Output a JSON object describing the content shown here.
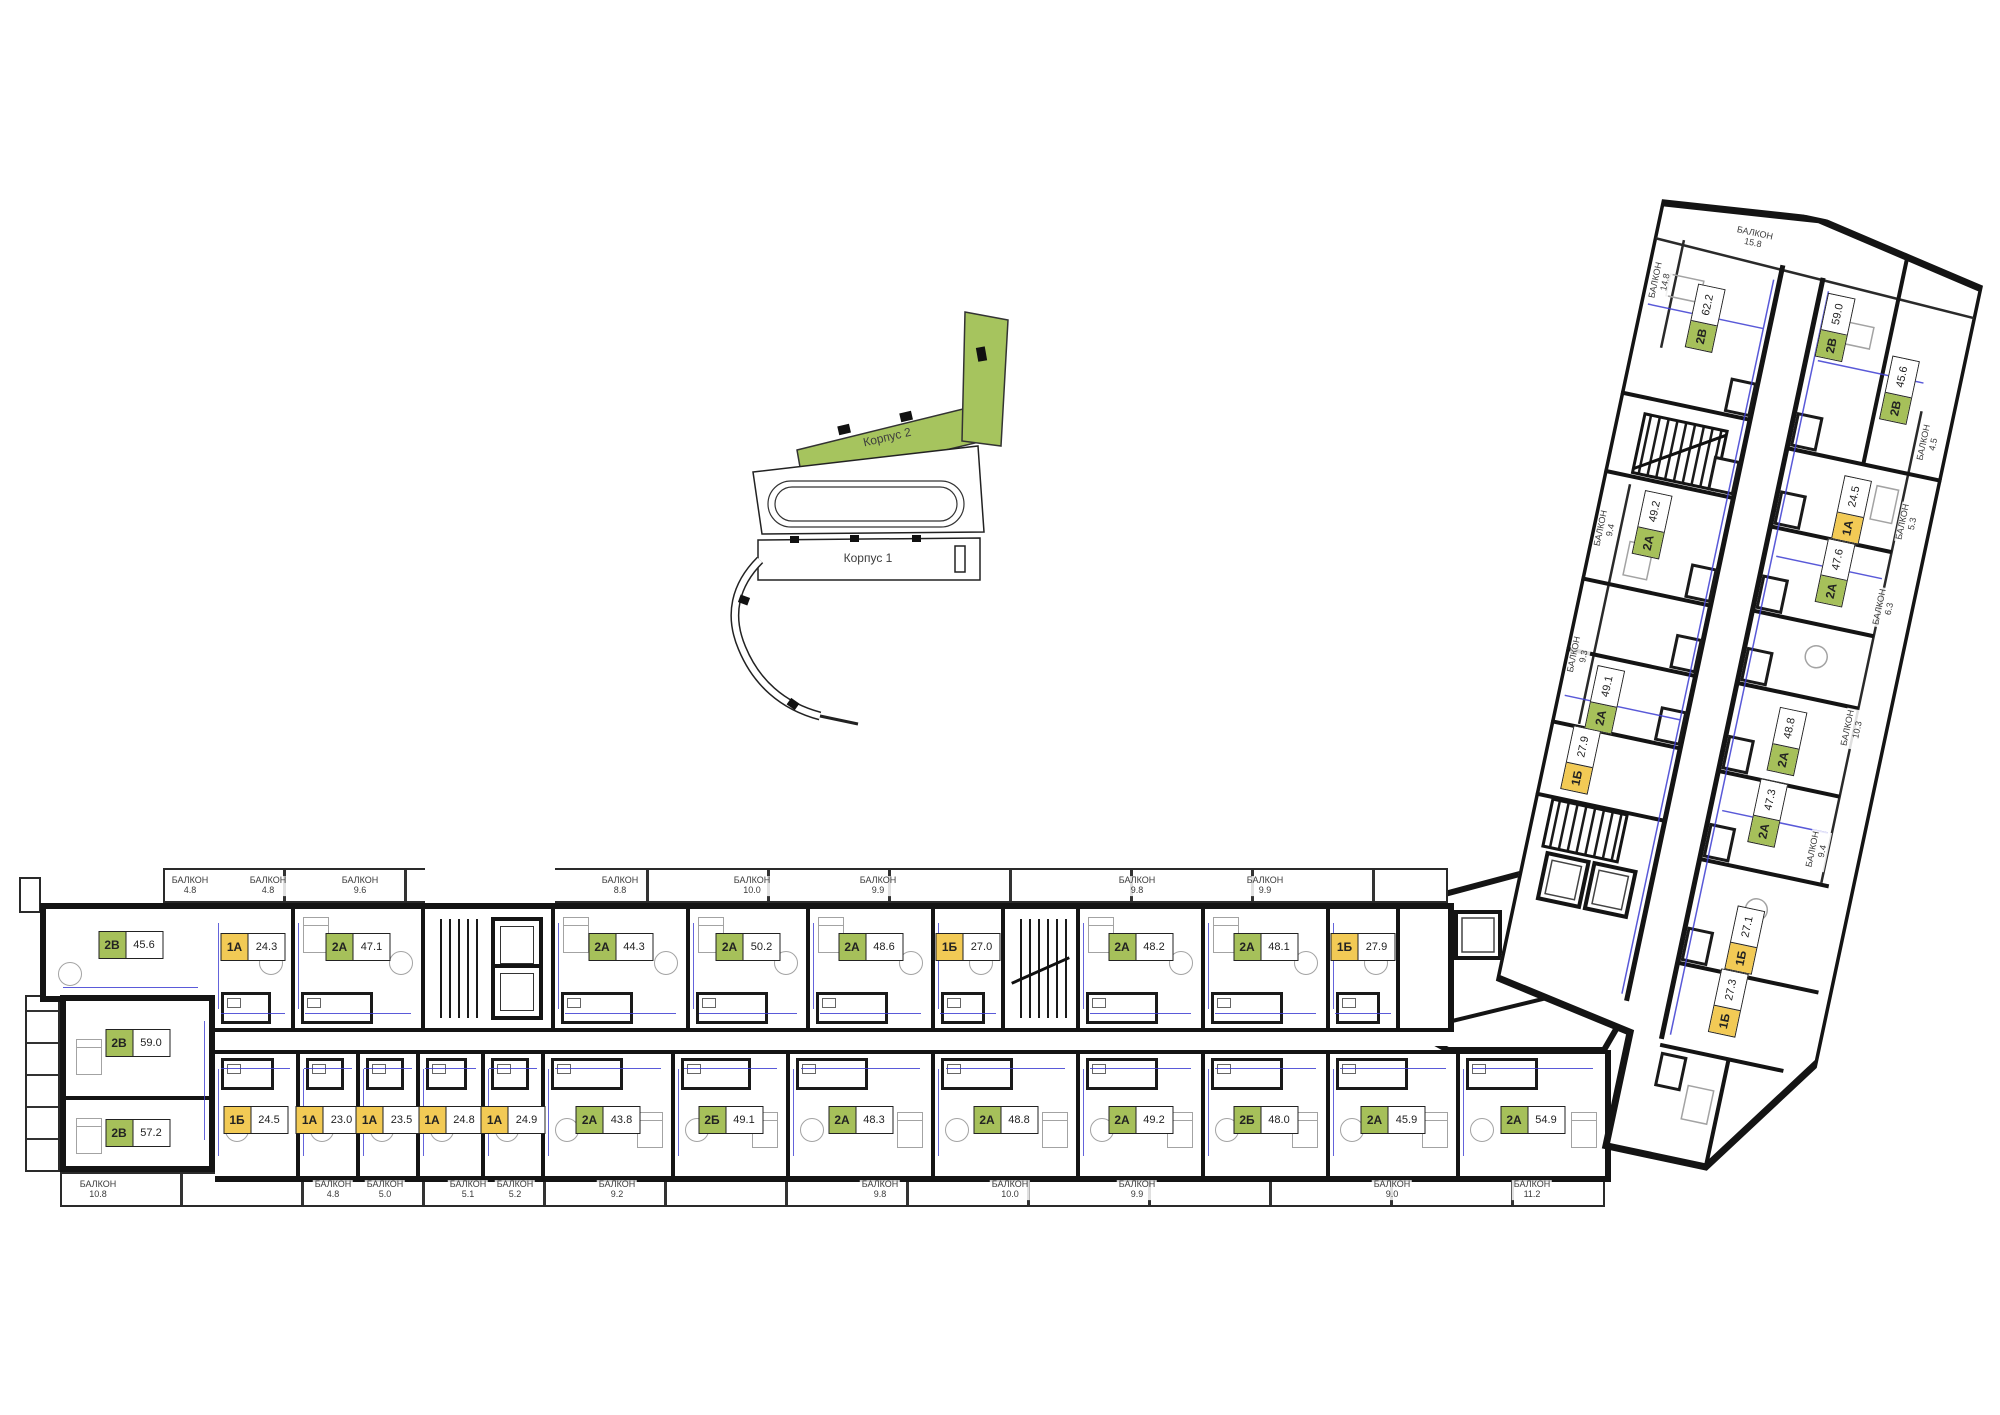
{
  "title_hidden": "",
  "colors": {
    "green": "#a6c05a",
    "yellow": "#f2ca55",
    "wall": "#141414",
    "dim_blue": "#3d3dd2",
    "furniture": "#a3a3a3",
    "balcony_text": "#3a3a3a",
    "locator_green": "#a6c45e"
  },
  "locator": {
    "building2": "Корпус 2",
    "building1": "Корпус 1"
  },
  "balcony_word": "БАЛКОН",
  "left_units": [
    {
      "t": "2В",
      "a": "45.6",
      "c": "g"
    },
    {
      "t": "2В",
      "a": "59.0",
      "c": "g"
    },
    {
      "t": "2В",
      "a": "57.2",
      "c": "g"
    }
  ],
  "h_top_units": [
    {
      "kind": "unit",
      "t": "1А",
      "a": "24.3",
      "c": "y",
      "w": 80
    },
    {
      "kind": "unit",
      "t": "2А",
      "a": "47.1",
      "c": "g",
      "w": 130
    },
    {
      "kind": "core",
      "w": 130
    },
    {
      "kind": "unit",
      "t": "2А",
      "a": "44.3",
      "c": "g",
      "w": 135
    },
    {
      "kind": "unit",
      "t": "2А",
      "a": "50.2",
      "c": "g",
      "w": 120
    },
    {
      "kind": "unit",
      "t": "2А",
      "a": "48.6",
      "c": "g",
      "w": 125
    },
    {
      "kind": "unit",
      "t": "1Б",
      "a": "27.0",
      "c": "y",
      "w": 70
    },
    {
      "kind": "stairs",
      "w": 75
    },
    {
      "kind": "unit",
      "t": "2А",
      "a": "48.2",
      "c": "g",
      "w": 125
    },
    {
      "kind": "unit",
      "t": "2А",
      "a": "48.1",
      "c": "g",
      "w": 125
    },
    {
      "kind": "unit",
      "t": "1Б",
      "a": "27.9",
      "c": "y",
      "w": 70
    },
    {
      "kind": "lobby",
      "w": 48
    }
  ],
  "h_bottom_units": [
    {
      "kind": "unit",
      "t": "1Б",
      "a": "24.5",
      "c": "y",
      "w": 85
    },
    {
      "kind": "unit",
      "t": "1А",
      "a": "23.0",
      "c": "y",
      "w": 60
    },
    {
      "kind": "unit",
      "t": "1А",
      "a": "23.5",
      "c": "y",
      "w": 60
    },
    {
      "kind": "unit",
      "t": "1А",
      "a": "24.8",
      "c": "y",
      "w": 65
    },
    {
      "kind": "unit",
      "t": "1А",
      "a": "24.9",
      "c": "y",
      "w": 60
    },
    {
      "kind": "unit",
      "t": "2А",
      "a": "43.8",
      "c": "g",
      "w": 130
    },
    {
      "kind": "unit",
      "t": "2Б",
      "a": "49.1",
      "c": "g",
      "w": 115
    },
    {
      "kind": "unit",
      "t": "2А",
      "a": "48.3",
      "c": "g",
      "w": 145
    },
    {
      "kind": "unit",
      "t": "2А",
      "a": "48.8",
      "c": "g",
      "w": 145
    },
    {
      "kind": "unit",
      "t": "2А",
      "a": "49.2",
      "c": "g",
      "w": 125
    },
    {
      "kind": "unit",
      "t": "2Б",
      "a": "48.0",
      "c": "g",
      "w": 125
    },
    {
      "kind": "unit",
      "t": "2А",
      "a": "45.9",
      "c": "g",
      "w": 130
    },
    {
      "kind": "unit",
      "t": "2А",
      "a": "54.9",
      "c": "g",
      "w": 145
    }
  ],
  "h_top_balconies": [
    {
      "v": "4.8",
      "x": 190
    },
    {
      "v": "4.8",
      "x": 268
    },
    {
      "v": "9.6",
      "x": 360
    },
    {
      "v": "8.8",
      "x": 620
    },
    {
      "v": "10.0",
      "x": 752
    },
    {
      "v": "9.9",
      "x": 878
    },
    {
      "v": "9.8",
      "x": 1137
    },
    {
      "v": "9.9",
      "x": 1265
    }
  ],
  "h_bottom_balconies": [
    {
      "v": "10.8",
      "x": 98
    },
    {
      "v": "4.8",
      "x": 333
    },
    {
      "v": "5.0",
      "x": 385
    },
    {
      "v": "5.1",
      "x": 468
    },
    {
      "v": "5.2",
      "x": 515
    },
    {
      "v": "9.2",
      "x": 617
    },
    {
      "v": "9.8",
      "x": 880
    },
    {
      "v": "10.0",
      "x": 1010
    },
    {
      "v": "9.9",
      "x": 1137
    },
    {
      "v": "9.0",
      "x": 1392
    },
    {
      "v": "11.2",
      "x": 1532
    }
  ],
  "d_units": [
    {
      "t": "2В",
      "a": "62.2",
      "c": "g",
      "x": 67,
      "y": 122
    },
    {
      "t": "2В",
      "a": "59.0",
      "c": "g",
      "x": 196,
      "y": 104
    },
    {
      "t": "2В",
      "a": "45.6",
      "c": "g",
      "x": 272,
      "y": 152
    },
    {
      "t": "1А",
      "a": "24.5",
      "c": "y",
      "x": 250,
      "y": 279
    },
    {
      "t": "2А",
      "a": "47.6",
      "c": "g",
      "x": 247,
      "y": 344
    },
    {
      "t": "2А",
      "a": "48.8",
      "c": "g",
      "x": 235,
      "y": 519
    },
    {
      "t": "2А",
      "a": "47.3",
      "c": "g",
      "x": 231,
      "y": 593
    },
    {
      "t": "1Б",
      "a": "27.1",
      "c": "y",
      "x": 235,
      "y": 722
    },
    {
      "t": "1Б",
      "a": "27.3",
      "c": "y",
      "x": 232,
      "y": 787
    },
    {
      "t": "2А",
      "a": "49.2",
      "c": "g",
      "x": 58,
      "y": 335
    },
    {
      "t": "2А",
      "a": "49.1",
      "c": "g",
      "x": 48,
      "y": 516
    },
    {
      "t": "1Б",
      "a": "27.9",
      "c": "y",
      "x": 37,
      "y": 580
    }
  ],
  "d_balconies": [
    {
      "v": "15.8",
      "x": 98,
      "y": 34,
      "o": "h"
    },
    {
      "v": "14.8",
      "x": 16,
      "y": 95,
      "o": "v"
    },
    {
      "v": "9.4",
      "x": 14,
      "y": 349,
      "o": "v"
    },
    {
      "v": "9.3",
      "x": 14,
      "y": 478,
      "o": "v"
    },
    {
      "v": "4.5",
      "x": 312,
      "y": 198,
      "o": "v"
    },
    {
      "v": "5.3",
      "x": 308,
      "y": 280,
      "o": "v"
    },
    {
      "v": "6.3",
      "x": 303,
      "y": 368,
      "o": "v"
    },
    {
      "v": "10.3",
      "x": 297,
      "y": 493,
      "o": "v"
    },
    {
      "v": "9.4",
      "x": 288,
      "y": 619,
      "o": "v"
    }
  ]
}
